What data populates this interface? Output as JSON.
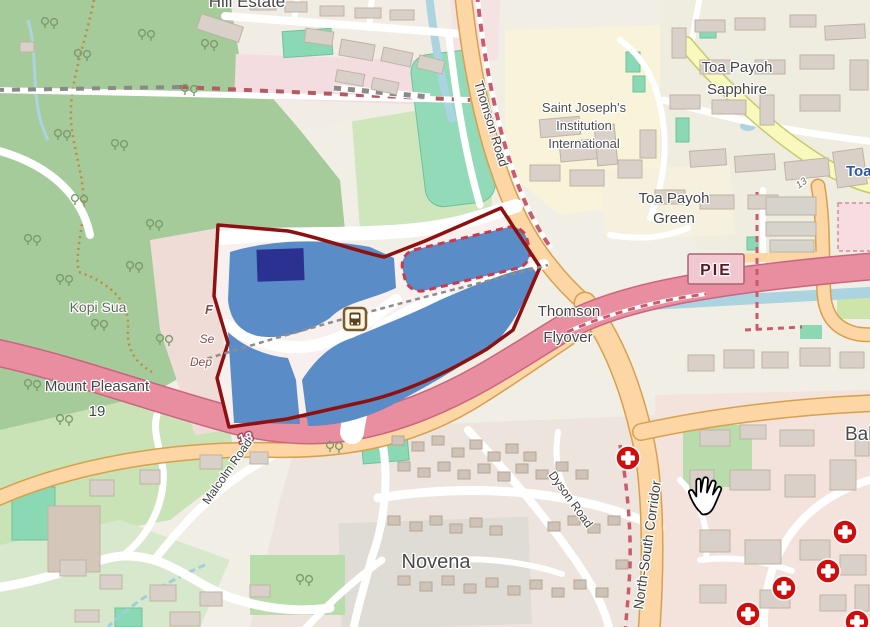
{
  "map": {
    "place_labels": {
      "hill_estate": "Hill Estate",
      "saint_josephs_1": "Saint Joseph's",
      "saint_josephs_2": "Institution",
      "saint_josephs_3": "International",
      "toa_payoh_sapphire_1": "Toa Payoh",
      "toa_payoh_sapphire_2": "Sapphire",
      "toa_payoh_green_1": "Toa Payoh",
      "toa_payoh_green_2": "Green",
      "toa_payoh_station": "Toa",
      "kopi_sua": "Kopi Sua",
      "mount_pleasant": "Mount Pleasant",
      "mount_pleasant_19": "19",
      "thomson_flyover_1": "Thomson",
      "thomson_flyover_2": "Flyover",
      "novena": "Novena",
      "balestier": "Bal"
    },
    "road_labels": {
      "thomson_road": "Thomson Road",
      "pie_shield": "PIE",
      "exit_18": "18",
      "ramp_13": "13",
      "malcolm_road": "Malcolm Road",
      "dyson_road": "Dyson Road",
      "north_south_corridor": "North-South Corridor"
    },
    "construction_labels": {
      "partial_1": "F",
      "partial_2": "Se",
      "partial_3": "Dep"
    },
    "icons": {
      "bus_station": "bus-station-icon",
      "hospital": "hospital-cross-icon",
      "hand_cursor": "hand-grab-cursor"
    },
    "colors": {
      "highlight_fill": "#5a8dc7",
      "highlight_dark_rect": "#2b3190",
      "boundary_red": "#8e1010",
      "dashed_subarea_red": "#c83a4e",
      "motorway_pink": "#e98da0",
      "primary_orange": "#fcd6a4",
      "secondary_yellow": "#f8fabd",
      "water_blue": "#abd4e0",
      "forest_green": "#a5cb9b",
      "pitch_teal": "#8bd8b4",
      "building_tan": "#d9d0c9",
      "marker_red": "#cf0d0d"
    }
  }
}
